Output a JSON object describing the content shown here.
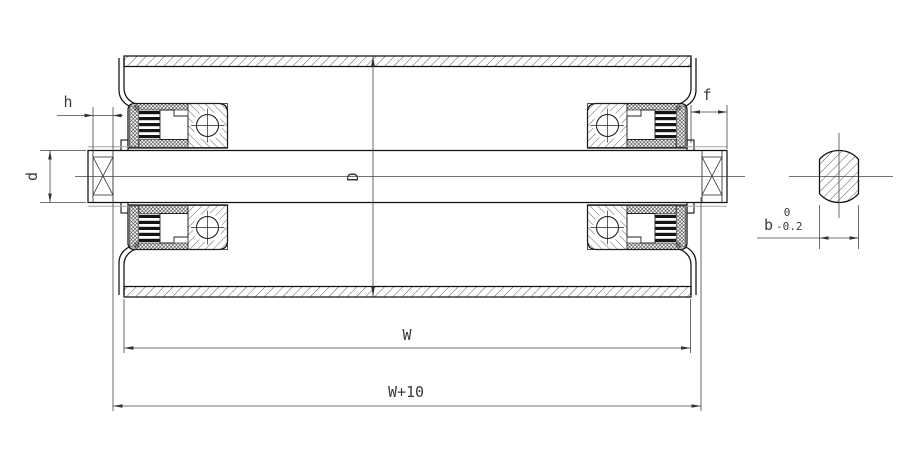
{
  "drawing": {
    "title": "conveyor-roller-cross-section",
    "labels": {
      "h": "h",
      "d": "d",
      "D": "D",
      "f": "f",
      "W": "W",
      "W_plus_10": "W+10",
      "b": "b",
      "tol_upper": "0",
      "tol_lower": "-0.2"
    },
    "colors": {
      "background": "#ffffff",
      "line": "#111111",
      "dimension_line": "#444444",
      "accent_grey": "#a8a8a8",
      "text": "#3a3a3a"
    }
  }
}
